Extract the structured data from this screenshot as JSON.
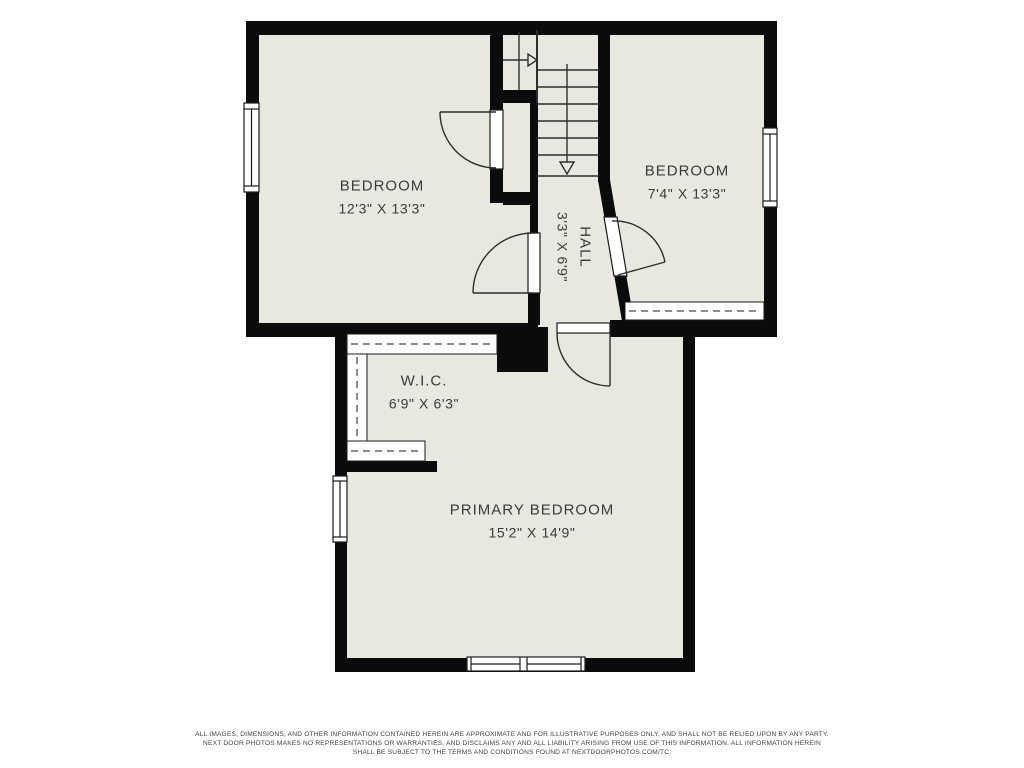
{
  "plan": {
    "rooms": [
      {
        "name": "BEDROOM",
        "dimensions": "12'3\" X 13'3\""
      },
      {
        "name": "BEDROOM",
        "dimensions": "7'4\" X 13'3\""
      },
      {
        "name": "HALL",
        "dimensions": "3'3\" X 6'9\""
      },
      {
        "name": "W.I.C.",
        "dimensions": "6'9\" X 6'3\""
      },
      {
        "name": "PRIMARY BEDROOM",
        "dimensions": "15'2\" X 14'9\""
      }
    ],
    "colors": {
      "floor": "#e9e8e0",
      "wall": "#0b0b0b",
      "background": "#ffffff",
      "label_text": "#3a3a3a"
    }
  },
  "disclaimer": {
    "line1": "ALL IMAGES, DIMENSIONS, AND OTHER INFORMATION CONTAINED HEREIN ARE APPROXIMATE AND FOR ILLUSTRATIVE PURPOSES ONLY, AND SHALL NOT BE RELIED UPON BY ANY PARTY.",
    "line2": "NEXT DOOR PHOTOS MAKES NO REPRESENTATIONS OR WARRANTIES, AND DISCLAIMS ANY AND ALL LIABILITY ARISING FROM USE OF THIS INFORMATION. ALL INFORMATION HEREIN",
    "line3": "SHALL BE SUBJECT TO THE TERMS AND CONDITIONS FOUND AT NEXTDOORPHOTOS.COM/TC."
  }
}
